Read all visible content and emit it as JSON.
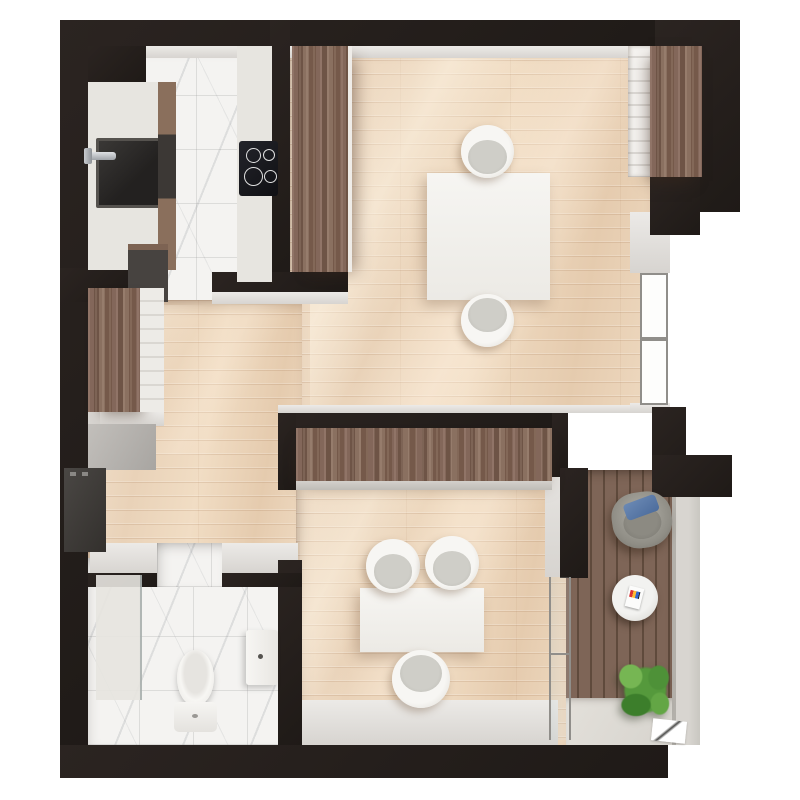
{
  "title": "apartment-floor-plan-top-down-render",
  "render_type": "3d-top-down-architectural-render",
  "colors": {
    "paper": "#ffffff",
    "wall": "#2b2421",
    "wall_dark": "#1f1a17",
    "wall_face": "#eceae7",
    "ledge": "#d7d4d0",
    "wood_floor": "#ead5bf",
    "wood_floor_highlight": "#f6e8d6",
    "cabinet_wood": "#7b6151",
    "deck_wood": "#79604f",
    "marble": "#f4f3f1",
    "terrazzo_counter": "#e7e5e0",
    "white_furniture": "#f3f1eb",
    "chair_seat_gray": "#c8c7c1",
    "sink_basin_dark": "#2e2c2a",
    "chrome": "#b9bcbf",
    "cooktop_black": "#15161a",
    "armchair_gray": "#8f8d85",
    "pillow_blue": "#5878a6",
    "plant_green": "#55993c",
    "concrete_parapet": "#d8d5d0",
    "glass_frame": "#908e8a",
    "hall_cabinet_dark": "#3b3835",
    "hall_box_gray": "#b5b2ae"
  },
  "rooms": [
    {
      "name": "kitchen",
      "floor": "white-marble-tile"
    },
    {
      "name": "living-dining-room",
      "floor": "light-oak-plank"
    },
    {
      "name": "hallway",
      "floor": "light-oak-plank"
    },
    {
      "name": "bathroom",
      "floor": "white-marble-tile"
    },
    {
      "name": "bedroom",
      "floor": "light-oak-plank"
    },
    {
      "name": "balcony",
      "floor": "dark-wood-decking-and-stone-pavers"
    }
  ],
  "furniture": {
    "kitchen": [
      "terrazzo-countertop-with-dark-sink",
      "chrome-faucet",
      "cabinet-strip",
      "terrazzo-countertop-with-cooktop",
      "four-burner-cooktop",
      "dark-base-cabinet",
      "tall-walnut-pantry-column"
    ],
    "living_dining": [
      "square-white-dining-table",
      "shell-chair-north",
      "shell-chair-south",
      "walnut-wardrobe-northeast",
      "white-shelf-unit",
      "tall-window-east-wall"
    ],
    "hallway": [
      "walnut-wardrobe-in-niche",
      "gray-storage-box",
      "dark-wall-cabinet"
    ],
    "bathroom": [
      "walk-in-shower-with-glass",
      "wall-hung-toilet",
      "wall-hung-washbasin"
    ],
    "bedroom": [
      "walnut-wardrobe-north-wall",
      "white-desk-table",
      "shell-chair-northwest",
      "shell-chair-northeast",
      "shell-chair-south",
      "sliding-glass-balcony-door"
    ],
    "balcony": [
      "gray-lounge-armchair",
      "blue-pillow",
      "round-marble-side-table",
      "magazine",
      "potted-green-plant",
      "concrete-parapet",
      "door-threshold"
    ]
  }
}
